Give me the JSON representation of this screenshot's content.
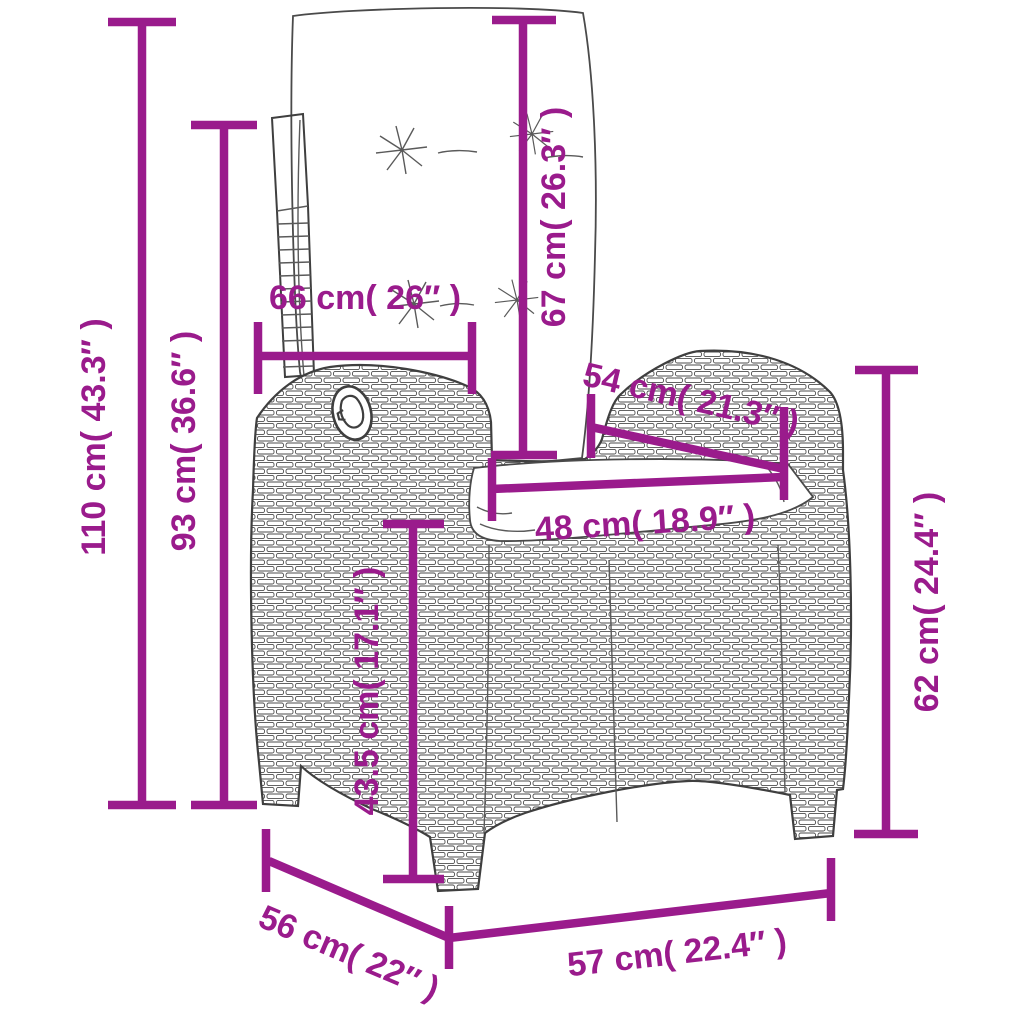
{
  "diagram": {
    "subject": "reclining-rattan-chair-with-cushions",
    "background_color": "#ffffff",
    "accent_color": "#9A1B8C",
    "outline_color": "#3f3f3f",
    "units": [
      "cm",
      "in"
    ]
  },
  "dimensions": {
    "overall_height": {
      "label": "110 cm( 43.3″ )",
      "cm": "110",
      "in": "43.3"
    },
    "back_height": {
      "label": "93 cm( 36.6″ )",
      "cm": "93",
      "in": "36.6"
    },
    "back_width": {
      "label": "66 cm( 26″ )",
      "cm": "66",
      "in": "26"
    },
    "backrest_length": {
      "label": "67 cm( 26.3″ )",
      "cm": "67",
      "in": "26.3"
    },
    "seat_diagonal": {
      "label": "54 cm( 21.3″ )",
      "cm": "54",
      "in": "21.3"
    },
    "seat_width": {
      "label": "48 cm( 18.9″ )",
      "cm": "48",
      "in": "18.9"
    },
    "seat_height": {
      "label": "43.5 cm( 17.1″ )",
      "cm": "43.5",
      "in": "17.1"
    },
    "armrest_height": {
      "label": "62 cm( 24.4″ )",
      "cm": "62",
      "in": "24.4"
    },
    "depth": {
      "label": "56 cm( 22″ )",
      "cm": "56",
      "in": "22"
    },
    "width": {
      "label": "57 cm( 22.4″ )",
      "cm": "57",
      "in": "22.4"
    }
  }
}
